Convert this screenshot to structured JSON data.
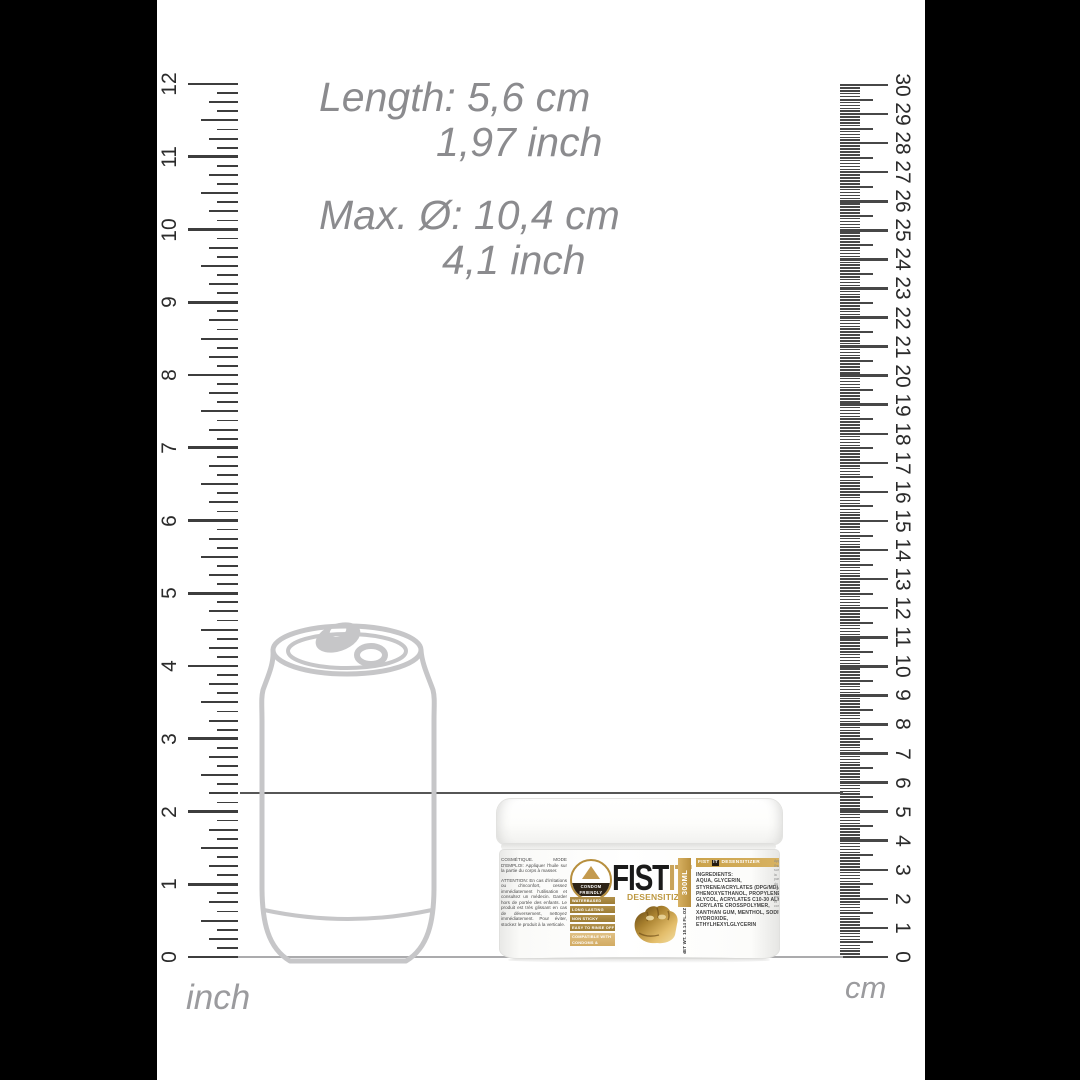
{
  "measurements": {
    "length_cm": "Length: 5,6 cm",
    "length_inch": "1,97 inch",
    "diameter_cm": "Max. Ø: 10,4 cm",
    "diameter_inch": "4,1 inch"
  },
  "rulers": {
    "inch": {
      "label": "inch",
      "numbers": [
        "0",
        "1",
        "2",
        "3",
        "4",
        "5",
        "6",
        "7",
        "8",
        "9",
        "10",
        "11",
        "12"
      ]
    },
    "cm": {
      "label": "cm",
      "numbers": [
        "0",
        "1",
        "2",
        "3",
        "4",
        "5",
        "6",
        "7",
        "8",
        "9",
        "10",
        "11",
        "12",
        "13",
        "14",
        "15",
        "16",
        "17",
        "18",
        "19",
        "20",
        "21",
        "22",
        "23",
        "24",
        "25",
        "26",
        "27",
        "28",
        "29",
        "30"
      ]
    }
  },
  "product": {
    "brand_black": "FIST",
    "brand_gold": "IT",
    "subtitle": "DESENSITIZER",
    "volume_strip": "300ML",
    "net_weight": "NET WT. 10.14 FL.OZ",
    "condom_badge": {
      "line1": "CONDOM",
      "line2": "FRIENDLY"
    },
    "feature_chips": [
      "WATERBASED",
      "LONG LASTING",
      "NON STICKY",
      "EASY TO RINSE OFF"
    ],
    "feature_chip_wide": "COMPATIBLE WITH CONDOMS & GLOVES",
    "right_label": {
      "header_left": "FIST",
      "header_mid": "IT",
      "header_right": "DESENSITIZER",
      "ingredients": "INGREDIENTS:\nAQUA, GLYCERIN, STYRENE/ACRYLATES (DPG/MD), PHENOXYETHANOL, PROPYLENE GLYCOL, ACRYLATES C10-30 ALKYL ACRYLATE CROSSPOLYMER, XANTHAN GUM, MENTHOL, SODIUM HYDROXIDE, ETHYLHEXYLGLYCERIN"
    },
    "usage_fr_1": "COSMÉTIQUE. MODE D'EMPLOI: Appliquer l'huile sur la partie du corps à masser.",
    "usage_fr_2": "ATTENTION: En cas d'irritations ou d'inconfort, cessez immédiatement l'utilisation et consultez un médecin. Garder hors de portée des enfants. Le produit est très glissant en cas de déversement, nettoyez immédiatement. Pour éviter, stockez le produit à la verticale.",
    "edge_text": "Appliquer l'huile sur la partie du corps à masser et consultez un médecin."
  },
  "colors": {
    "gold": "#c9a24b",
    "gold_dark": "#9c7c35",
    "gold_light": "#d2ab62",
    "tick": "#3d3d3d",
    "dimension_text": "#8b8b8e",
    "can_outline": "#c6c6c8"
  }
}
